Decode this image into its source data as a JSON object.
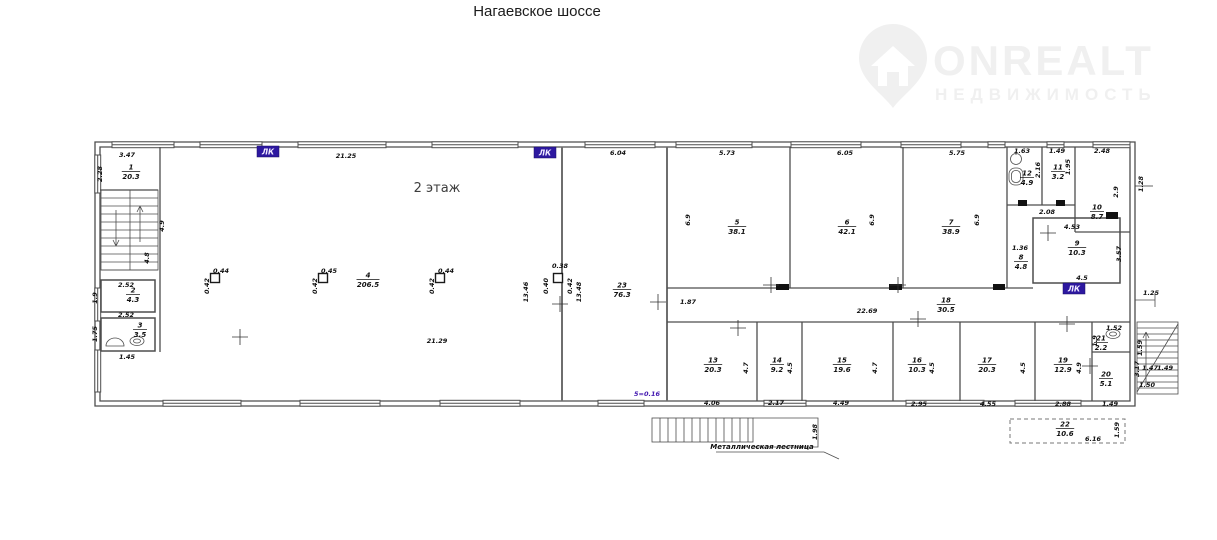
{
  "title": "Нагаевское шоссе",
  "logo": {
    "brand": "ONREALT",
    "subtitle": "НЕДВИЖИМОСТЬ",
    "color": "#f0f0f0"
  },
  "colors": {
    "accent_purple": "#2d18a0",
    "wall": "#4d4d4d",
    "text": "#101010"
  },
  "plan": {
    "floor_label": "2 этаж",
    "lk_label": "ЛК",
    "level_note": "5=0.16",
    "stair_note": "Металлическая лестница",
    "rooms": [
      {
        "num": "1",
        "area": "20.3",
        "x": 131,
        "y": 171
      },
      {
        "num": "2",
        "area": "4.3",
        "x": 133,
        "y": 294
      },
      {
        "num": "3",
        "area": "3.5",
        "x": 140,
        "y": 329
      },
      {
        "num": "4",
        "area": "206.5",
        "x": 368,
        "y": 279
      },
      {
        "num": "5",
        "area": "38.1",
        "x": 737,
        "y": 226
      },
      {
        "num": "6",
        "area": "42.1",
        "x": 847,
        "y": 226
      },
      {
        "num": "7",
        "area": "38.9",
        "x": 951,
        "y": 226
      },
      {
        "num": "8",
        "area": "4.8",
        "x": 1021,
        "y": 261
      },
      {
        "num": "9",
        "area": "10.3",
        "x": 1077,
        "y": 247
      },
      {
        "num": "10",
        "area": "8.7",
        "x": 1097,
        "y": 211
      },
      {
        "num": "11",
        "area": "3.2",
        "x": 1058,
        "y": 171
      },
      {
        "num": "12",
        "area": "4.9",
        "x": 1027,
        "y": 177
      },
      {
        "num": "13",
        "area": "20.3",
        "x": 713,
        "y": 364
      },
      {
        "num": "14",
        "area": "9.2",
        "x": 777,
        "y": 364
      },
      {
        "num": "15",
        "area": "19.6",
        "x": 842,
        "y": 364
      },
      {
        "num": "16",
        "area": "10.3",
        "x": 917,
        "y": 364
      },
      {
        "num": "17",
        "area": "20.3",
        "x": 987,
        "y": 364
      },
      {
        "num": "18",
        "area": "30.5",
        "x": 946,
        "y": 304
      },
      {
        "num": "19",
        "area": "12.9",
        "x": 1063,
        "y": 364
      },
      {
        "num": "20",
        "area": "5.1",
        "x": 1106,
        "y": 378
      },
      {
        "num": "21",
        "area": "2.2",
        "x": 1101,
        "y": 342
      },
      {
        "num": "22",
        "area": "10.6",
        "x": 1065,
        "y": 428
      },
      {
        "num": "23",
        "area": "76.3",
        "x": 622,
        "y": 289
      }
    ],
    "dims": [
      {
        "t": "3.47",
        "x": 127,
        "y": 157
      },
      {
        "t": "21.25",
        "x": 346,
        "y": 158
      },
      {
        "t": "6.04",
        "x": 618,
        "y": 155
      },
      {
        "t": "5.73",
        "x": 727,
        "y": 155
      },
      {
        "t": "6.05",
        "x": 845,
        "y": 155
      },
      {
        "t": "5.75",
        "x": 957,
        "y": 155
      },
      {
        "t": "1.63",
        "x": 1022,
        "y": 153
      },
      {
        "t": "1.49",
        "x": 1057,
        "y": 153
      },
      {
        "t": "2.48",
        "x": 1102,
        "y": 153
      },
      {
        "t": "2.28",
        "x": 102,
        "y": 174,
        "r": 1
      },
      {
        "t": "4.9",
        "x": 164,
        "y": 226,
        "r": 1
      },
      {
        "t": "4.8",
        "x": 149,
        "y": 258,
        "r": 1
      },
      {
        "t": "21.29",
        "x": 437,
        "y": 343
      },
      {
        "t": "0.44",
        "x": 221,
        "y": 273
      },
      {
        "t": "0.42",
        "x": 209,
        "y": 286,
        "r": 1
      },
      {
        "t": "0.45",
        "x": 329,
        "y": 273
      },
      {
        "t": "0.42",
        "x": 317,
        "y": 286,
        "r": 1
      },
      {
        "t": "0.44",
        "x": 446,
        "y": 273
      },
      {
        "t": "0.42",
        "x": 434,
        "y": 286,
        "r": 1
      },
      {
        "t": "0.38",
        "x": 560,
        "y": 268
      },
      {
        "t": "0.40",
        "x": 548,
        "y": 286,
        "r": 1
      },
      {
        "t": "0.42",
        "x": 572,
        "y": 286,
        "r": 1
      },
      {
        "t": "13.46",
        "x": 528,
        "y": 292,
        "r": 1
      },
      {
        "t": "13.48",
        "x": 581,
        "y": 292,
        "r": 1
      },
      {
        "t": "1.87",
        "x": 688,
        "y": 304
      },
      {
        "t": "6.9",
        "x": 690,
        "y": 220,
        "r": 1
      },
      {
        "t": "6.9",
        "x": 874,
        "y": 220,
        "r": 1
      },
      {
        "t": "6.9",
        "x": 979,
        "y": 220,
        "r": 1
      },
      {
        "t": "2.16",
        "x": 1040,
        "y": 170,
        "r": 1
      },
      {
        "t": "1.95",
        "x": 1070,
        "y": 167,
        "r": 1
      },
      {
        "t": "2.9",
        "x": 1118,
        "y": 192,
        "r": 1
      },
      {
        "t": "2.08",
        "x": 1047,
        "y": 214
      },
      {
        "t": "1.36",
        "x": 1020,
        "y": 250
      },
      {
        "t": "4.53",
        "x": 1072,
        "y": 229
      },
      {
        "t": "3.57",
        "x": 1121,
        "y": 254,
        "r": 1
      },
      {
        "t": "4.5",
        "x": 1082,
        "y": 280
      },
      {
        "t": "22.69",
        "x": 867,
        "y": 313
      },
      {
        "t": "4.7",
        "x": 748,
        "y": 368,
        "r": 1
      },
      {
        "t": "4.5",
        "x": 792,
        "y": 368,
        "r": 1
      },
      {
        "t": "4.7",
        "x": 877,
        "y": 368,
        "r": 1
      },
      {
        "t": "4.5",
        "x": 934,
        "y": 368,
        "r": 1
      },
      {
        "t": "4.5",
        "x": 1025,
        "y": 368,
        "r": 1
      },
      {
        "t": "4.9",
        "x": 1081,
        "y": 368,
        "r": 1
      },
      {
        "t": "4.06",
        "x": 712,
        "y": 405
      },
      {
        "t": "2.17",
        "x": 776,
        "y": 405
      },
      {
        "t": "4.49",
        "x": 841,
        "y": 405
      },
      {
        "t": "2.95",
        "x": 919,
        "y": 406
      },
      {
        "t": "4.55",
        "x": 988,
        "y": 406
      },
      {
        "t": "2.88",
        "x": 1063,
        "y": 406
      },
      {
        "t": "1.49",
        "x": 1110,
        "y": 406
      },
      {
        "t": "1.52",
        "x": 1114,
        "y": 330
      },
      {
        "t": "1.9",
        "x": 1097,
        "y": 341,
        "r": 1
      },
      {
        "t": "3.17",
        "x": 1139,
        "y": 369,
        "r": 1
      },
      {
        "t": "1.28",
        "x": 1143,
        "y": 184,
        "r": 1
      },
      {
        "t": "1.25",
        "x": 1151,
        "y": 295
      },
      {
        "t": "1.59",
        "x": 1142,
        "y": 348,
        "r": 1
      },
      {
        "t": "1.47",
        "x": 1150,
        "y": 370
      },
      {
        "t": "1.49",
        "x": 1165,
        "y": 370
      },
      {
        "t": "1.50",
        "x": 1147,
        "y": 387
      },
      {
        "t": "1.98",
        "x": 817,
        "y": 432,
        "r": 1
      },
      {
        "t": "2.52",
        "x": 126,
        "y": 287
      },
      {
        "t": "1.9",
        "x": 97,
        "y": 298,
        "r": 1
      },
      {
        "t": "2.52",
        "x": 126,
        "y": 317
      },
      {
        "t": "1.75",
        "x": 97,
        "y": 334,
        "r": 1
      },
      {
        "t": "1.45",
        "x": 127,
        "y": 359
      },
      {
        "t": "6.16",
        "x": 1093,
        "y": 441
      },
      {
        "t": "1.59",
        "x": 1119,
        "y": 430,
        "r": 1
      }
    ],
    "lk": [
      {
        "x": 257,
        "y": 146
      },
      {
        "x": 534,
        "y": 147
      },
      {
        "x": 1063,
        "y": 283
      }
    ]
  }
}
